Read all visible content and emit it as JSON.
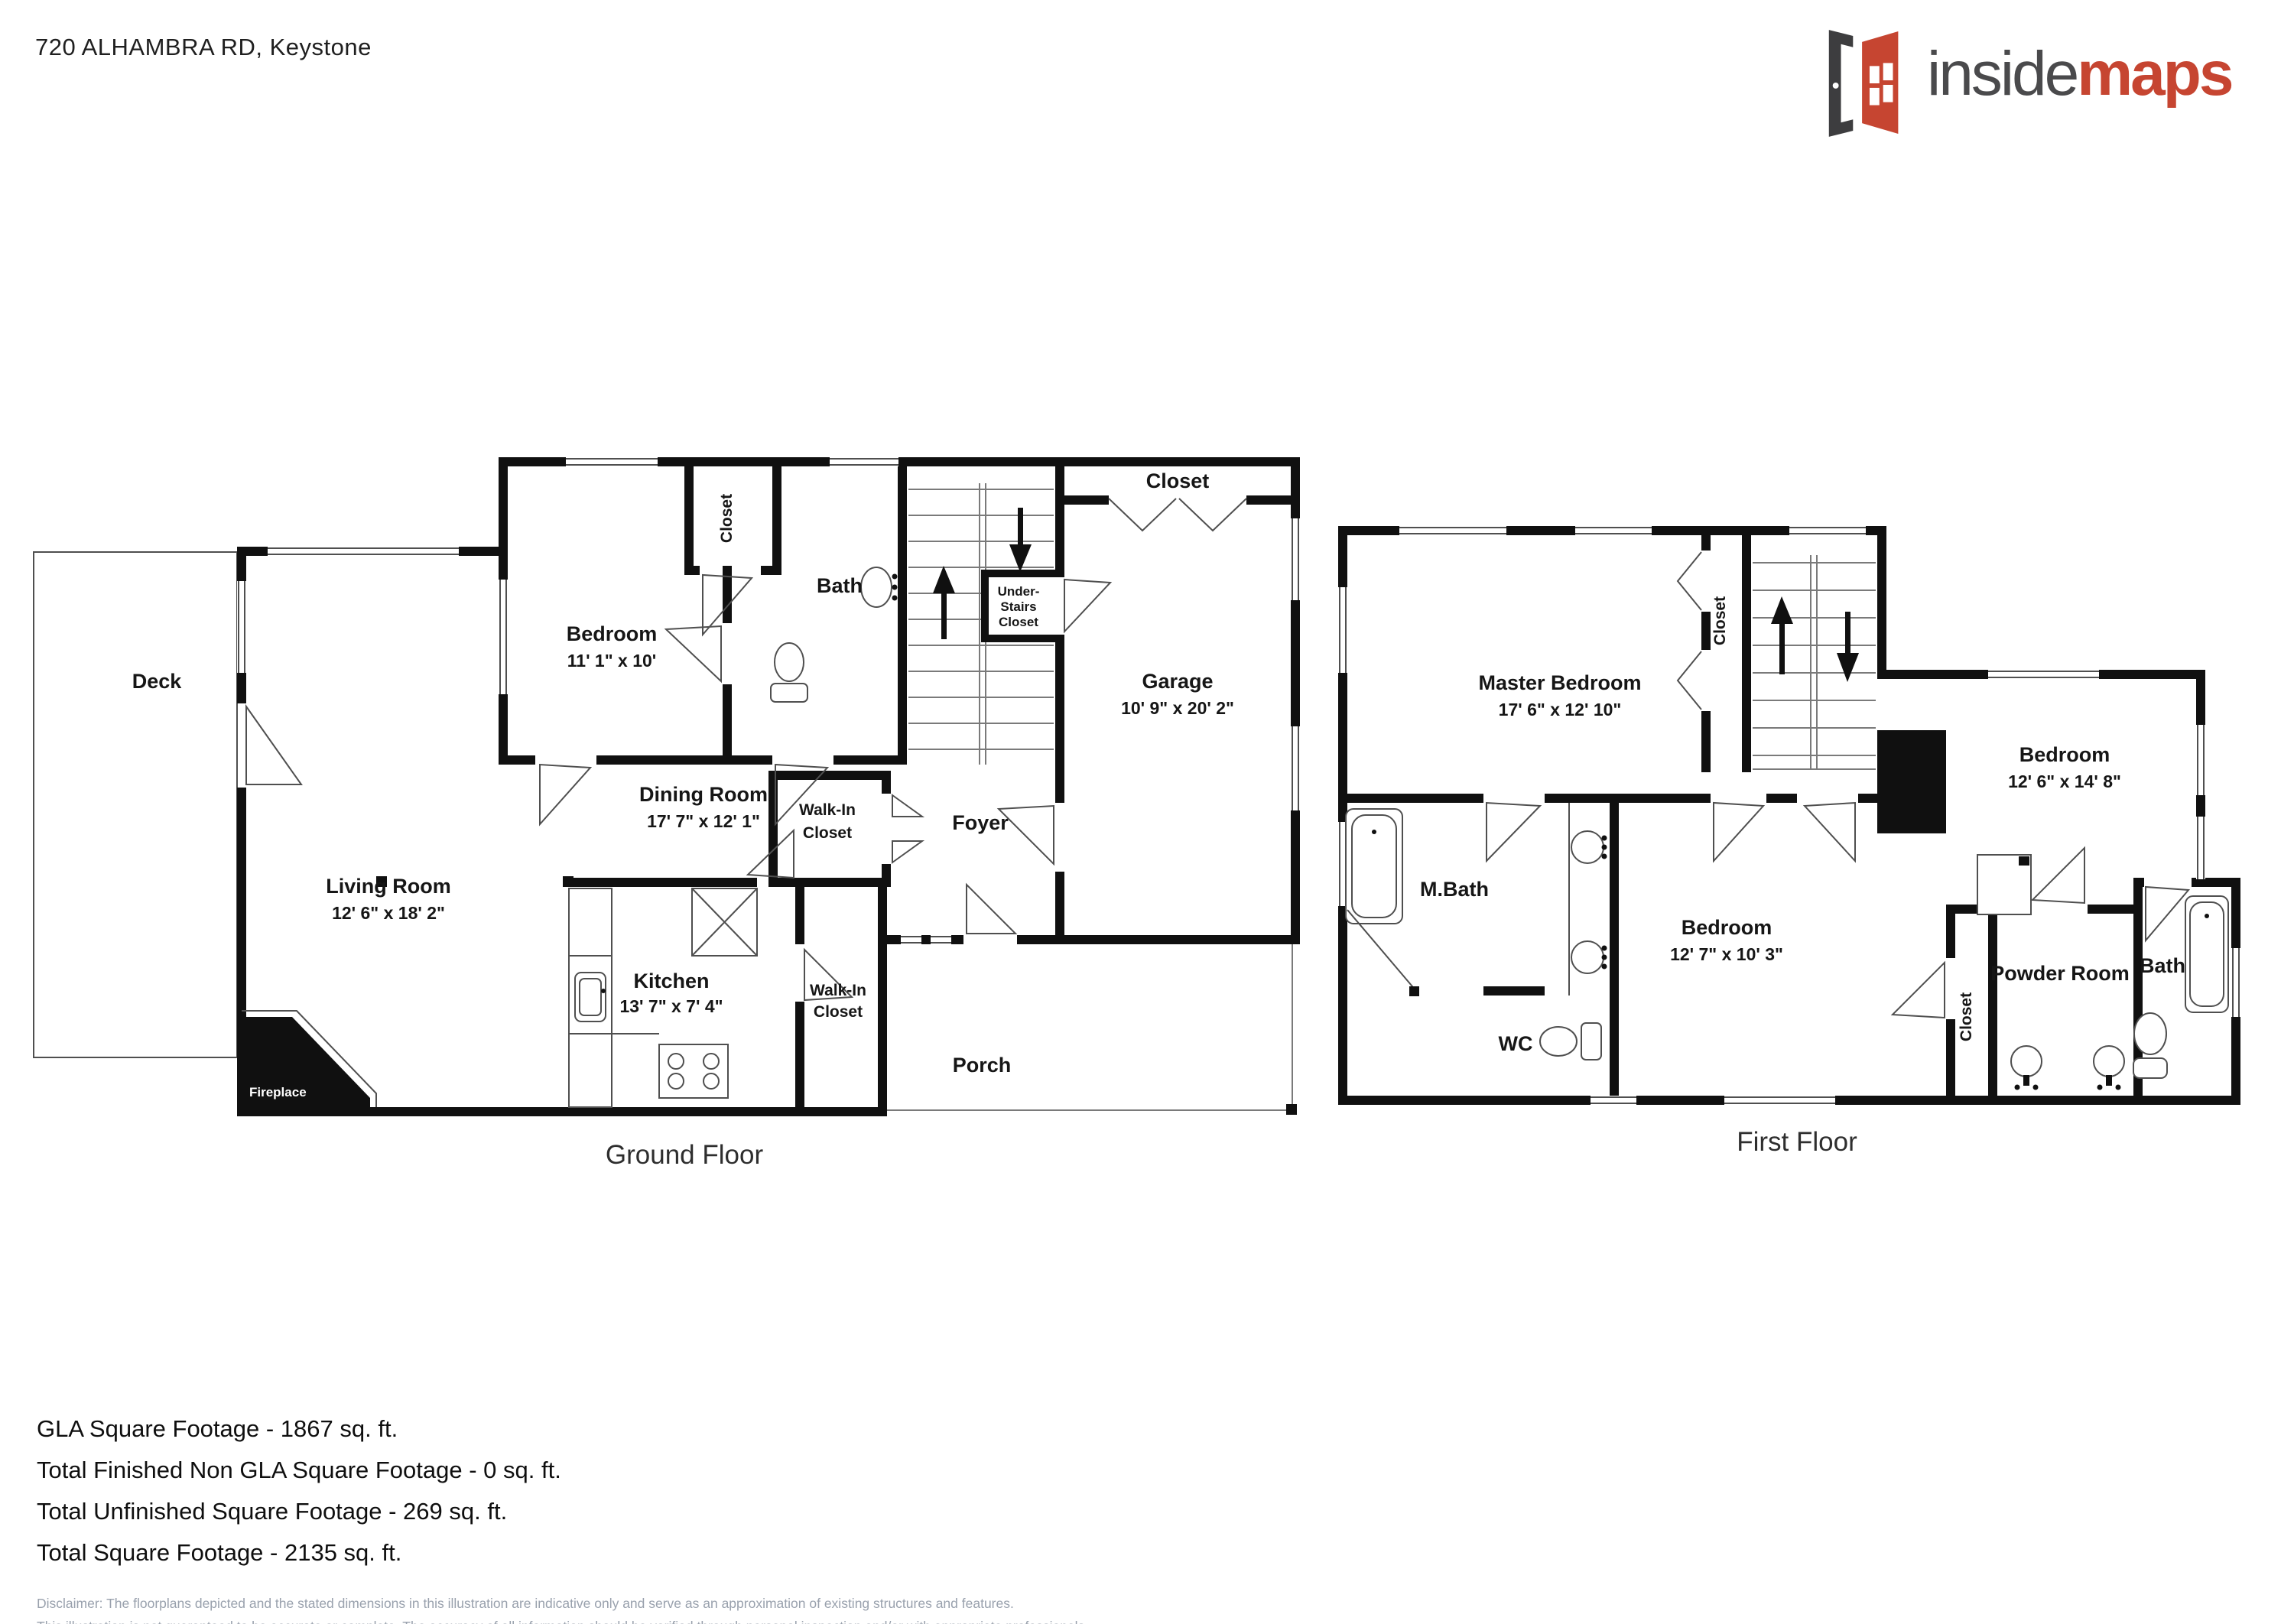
{
  "header": {
    "address": "720 ALHAMBRA RD, Keystone"
  },
  "logo": {
    "inside": "inside",
    "maps": "maps"
  },
  "ground_floor": {
    "title": "Ground Floor",
    "deck": "Deck",
    "bedroom": {
      "name": "Bedroom",
      "dims": "11' 1\" x 10'"
    },
    "bedroom_closet": "Closet",
    "bath": "Bath",
    "under_stairs_closet": {
      "line1": "Under-",
      "line2": "Stairs",
      "line3": "Closet"
    },
    "garage_closet": "Closet",
    "garage": {
      "name": "Garage",
      "dims": "10' 9\" x 20' 2\""
    },
    "dining_room": {
      "name": "Dining Room",
      "dims": "17' 7\" x 12' 1\""
    },
    "walk_in_closet_upper": {
      "line1": "Walk-In",
      "line2": "Closet"
    },
    "foyer": "Foyer",
    "living_room": {
      "name": "Living Room",
      "dims": "12' 6\" x 18' 2\""
    },
    "kitchen": {
      "name": "Kitchen",
      "dims": "13' 7\" x 7' 4\""
    },
    "walk_in_closet_lower": {
      "line1": "Walk-In",
      "line2": "Closet"
    },
    "porch": "Porch",
    "fireplace": "Fireplace"
  },
  "first_floor": {
    "title": "First Floor",
    "master_bedroom": {
      "name": "Master Bedroom",
      "dims": "17' 6\" x 12' 10\""
    },
    "stairs_closet": "Closet",
    "bedroom_right": {
      "name": "Bedroom",
      "dims": "12' 6\" x 14' 8\""
    },
    "m_bath": "M.Bath",
    "wc": "WC",
    "bedroom_mid": {
      "name": "Bedroom",
      "dims": "12' 7\" x 10' 3\""
    },
    "closet_mid": "Closet",
    "powder_room": "Powder Room",
    "bath": "Bath"
  },
  "footer": {
    "lines": [
      "GLA Square Footage - 1867 sq. ft.",
      "Total Finished Non GLA Square Footage - 0 sq. ft.",
      "Total Unfinished Square Footage - 269 sq. ft.",
      "Total Square Footage - 2135 sq. ft."
    ]
  },
  "disclaimer": {
    "line1": "Disclaimer: The floorplans depicted and the stated dimensions in this illustration are indicative only and serve as an approximation of existing structures and features.",
    "line2": "This illustration is not guaranteed to be accurate or complete. The accuracy of all information should be verified through personal inspection and/or with appropriate professionals."
  }
}
